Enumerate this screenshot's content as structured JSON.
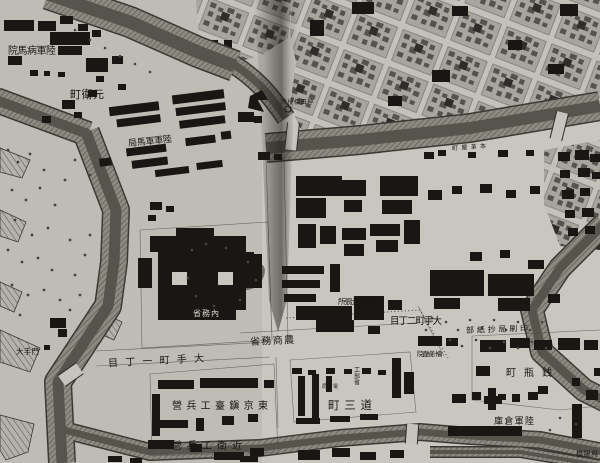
{
  "map": {
    "description_not_rendered": "",
    "colors": {
      "paper": "#c8c6bf",
      "paper_light": "#d2d0c8",
      "ink": "#171611",
      "building_black": "#181713",
      "moat_water": "#56544c",
      "moat_bank": "#8d8a82",
      "urban_block": "#a7a59e",
      "street": "#c3c1ba",
      "tree": "#45443f",
      "fold_shadow": "#1e1c18"
    },
    "labels": {
      "byomain": {
        "text": "院馬病軍陸"
      },
      "motoemachi": {
        "text": "町衛元"
      },
      "gunbakyoku": {
        "text": "局馬軍軍陸"
      },
      "kandabashi": {
        "text": "所役橋田神"
      },
      "honkawaya": {
        "text": "町屋革本"
      },
      "ekitei": {
        "text": "所張出局遞驛"
      },
      "otemachi2": {
        "text": "目丁二町手大"
      },
      "naimusho": {
        "text": "省務內"
      },
      "noshomusho": {
        "text": "省務商農"
      },
      "otemachi1": {
        "text": "目丁一町手大"
      },
      "chindai": {
        "text": "營兵工臺鎭京東"
      },
      "konoe": {
        "text": "營兵工衛近"
      },
      "dosancho": {
        "text": "町三道"
      },
      "insatsu": {
        "text": "部紙抄局刷印"
      },
      "kaikei": {
        "text": "院査檢計會"
      },
      "zenigame": {
        "text": "町瓶銭"
      },
      "soko": {
        "text": "庫倉軍陸"
      },
      "gofuku": {
        "text": "橋服呉"
      },
      "otemon": {
        "text": "大手門"
      },
      "kobusho": {
        "text": "工部省"
      },
      "denshin": {
        "text": "局信電"
      }
    }
  }
}
